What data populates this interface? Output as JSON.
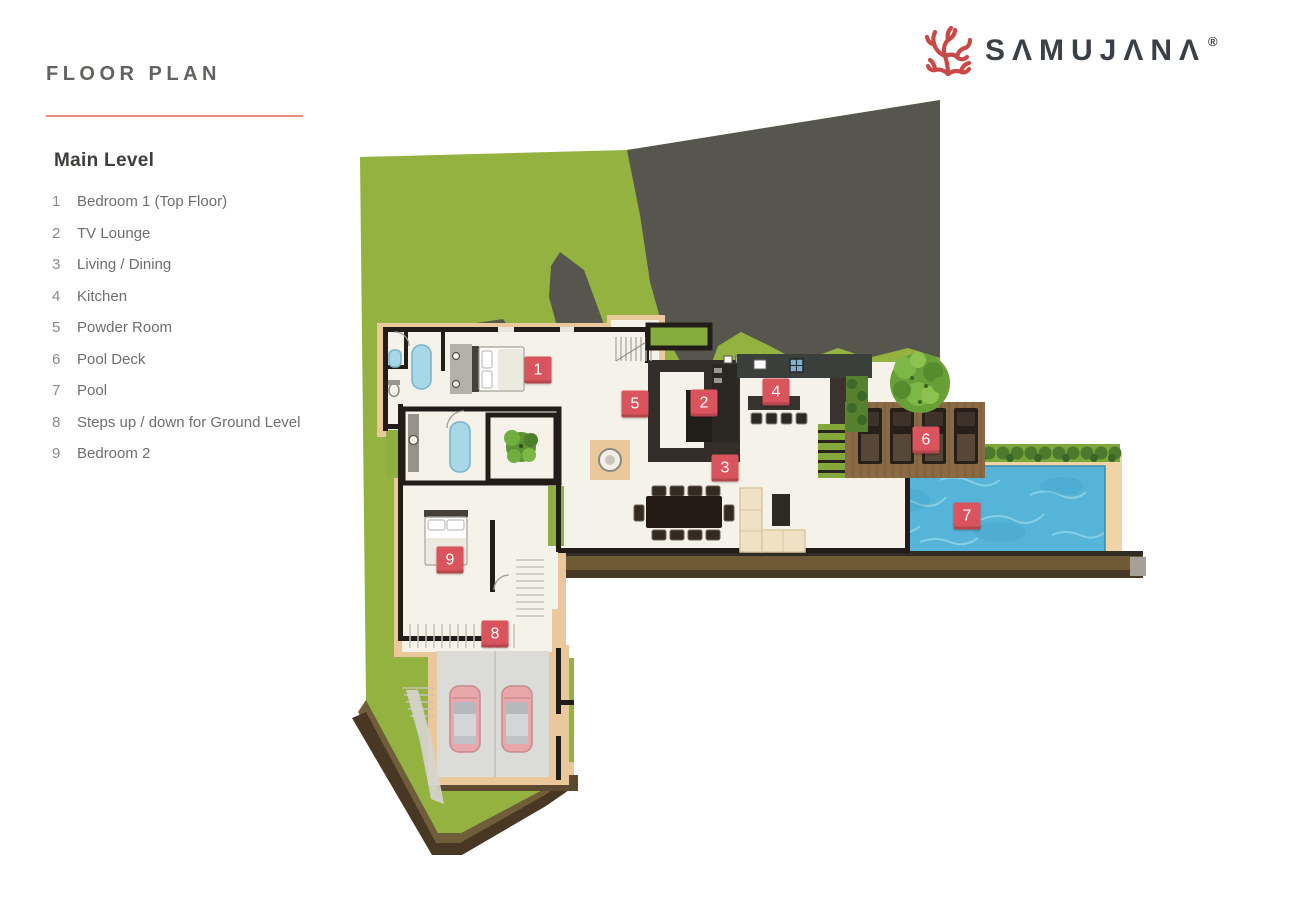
{
  "header": {
    "title": "FLOOR PLAN",
    "title_underline_color": "#ee8a7c",
    "logo": {
      "name": "SAMUJANA",
      "display_text": "SΛMUJΛNΛ",
      "registered_mark": "®",
      "coral_color": "#c94947",
      "text_color": "#3b4046"
    }
  },
  "legend": {
    "level_title": "Main Level",
    "items": [
      {
        "number": "1",
        "label": "Bedroom 1 (Top Floor)"
      },
      {
        "number": "2",
        "label": "TV Lounge"
      },
      {
        "number": "3",
        "label": "Living / Dining"
      },
      {
        "number": "4",
        "label": "Kitchen"
      },
      {
        "number": "5",
        "label": "Powder Room"
      },
      {
        "number": "6",
        "label": "Pool Deck"
      },
      {
        "number": "7",
        "label": "Pool"
      },
      {
        "number": "8",
        "label": "Steps up / down for Ground Level"
      },
      {
        "number": "9",
        "label": "Bedroom 2"
      }
    ]
  },
  "floor_plan": {
    "marker_color": "#d9545c",
    "markers": [
      {
        "number": "1",
        "room": "Bedroom 1 (Top Floor)",
        "x": 538,
        "y": 370
      },
      {
        "number": "2",
        "room": "TV Lounge",
        "x": 704,
        "y": 403
      },
      {
        "number": "3",
        "room": "Living / Dining",
        "x": 725,
        "y": 468
      },
      {
        "number": "4",
        "room": "Kitchen",
        "x": 776,
        "y": 392
      },
      {
        "number": "5",
        "room": "Powder Room",
        "x": 635,
        "y": 404
      },
      {
        "number": "6",
        "room": "Pool Deck",
        "x": 926,
        "y": 440
      },
      {
        "number": "7",
        "room": "Pool",
        "x": 967,
        "y": 516
      },
      {
        "number": "8",
        "room": "Steps up / down for Ground Level",
        "x": 495,
        "y": 634
      },
      {
        "number": "9",
        "room": "Bedroom 2",
        "x": 450,
        "y": 560
      }
    ],
    "palette": {
      "grass": "#93b23f",
      "rock": "#56564f",
      "floor": "#f5f2e9",
      "wall": "#221d18",
      "cork_border": "#e9c89c",
      "pool_water": "#55b4d8",
      "pool_sand": "#eed4a6",
      "deck_wood": "#8a6a44",
      "retaining_wall": "#6f5a36",
      "soil": "#483823",
      "hedge": "#4b792e",
      "car_body": "#e8a8ab"
    }
  }
}
